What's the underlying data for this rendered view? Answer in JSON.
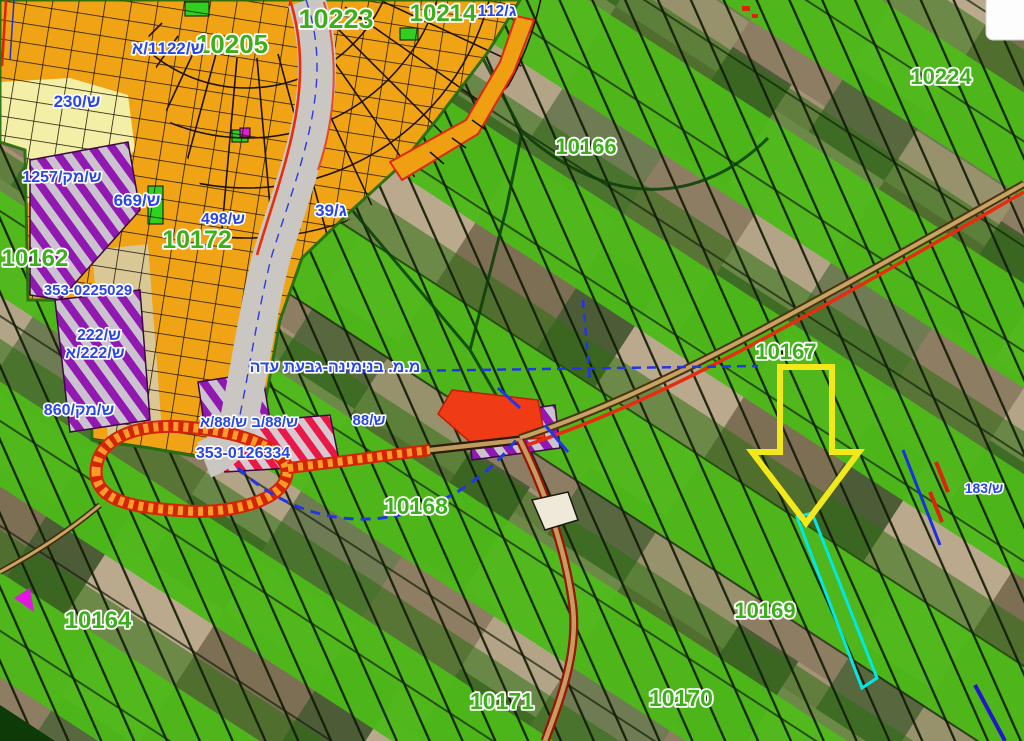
{
  "map": {
    "block_labels": [
      {
        "text": "10223"
      },
      {
        "text": "10205"
      },
      {
        "text": "10214"
      },
      {
        "text": "10224"
      },
      {
        "text": "10166"
      },
      {
        "text": "10172"
      },
      {
        "text": "10162"
      },
      {
        "text": "10167"
      },
      {
        "text": "10168"
      },
      {
        "text": "10164"
      },
      {
        "text": "10169"
      },
      {
        "text": "10171"
      },
      {
        "text": "10170"
      }
    ],
    "plan_labels": [
      {
        "text": "ש/1122/א"
      },
      {
        "text": "ג/112"
      },
      {
        "text": "ש/230"
      },
      {
        "text": "ש/מק/1257"
      },
      {
        "text": "ש/669"
      },
      {
        "text": "ש/498"
      },
      {
        "text": "ג/39"
      },
      {
        "text": "ש/222"
      },
      {
        "text": "ש/222/א"
      },
      {
        "text": "ש/מק/860"
      },
      {
        "text": "ש/88/ב ש/88/א"
      },
      {
        "text": "ש/88"
      },
      {
        "text": "ש/183"
      }
    ],
    "deal_labels": [
      {
        "text": "353-0225029"
      },
      {
        "text": "353-0126334"
      }
    ],
    "municipality_label": "מ.מ. בנימינה-גבעת עדה",
    "marker": {
      "name": "selection-arrow-marker",
      "shape": "arrow-down",
      "color": "#f3e91a"
    },
    "highlight": {
      "name": "highlighted-parcel",
      "color": "#00e8e8"
    },
    "colors": {
      "block_label": "#3bb01a",
      "plan_label": "#2946e8",
      "agriculture_green": "#4cb918",
      "urban_orange": "#efa315",
      "plan_purple": "#9118b0",
      "road_red": "#e82c10",
      "road_tan": "#c8a362",
      "highlight_cyan": "#00e8e8",
      "marker_yellow": "#f3e91a"
    }
  }
}
